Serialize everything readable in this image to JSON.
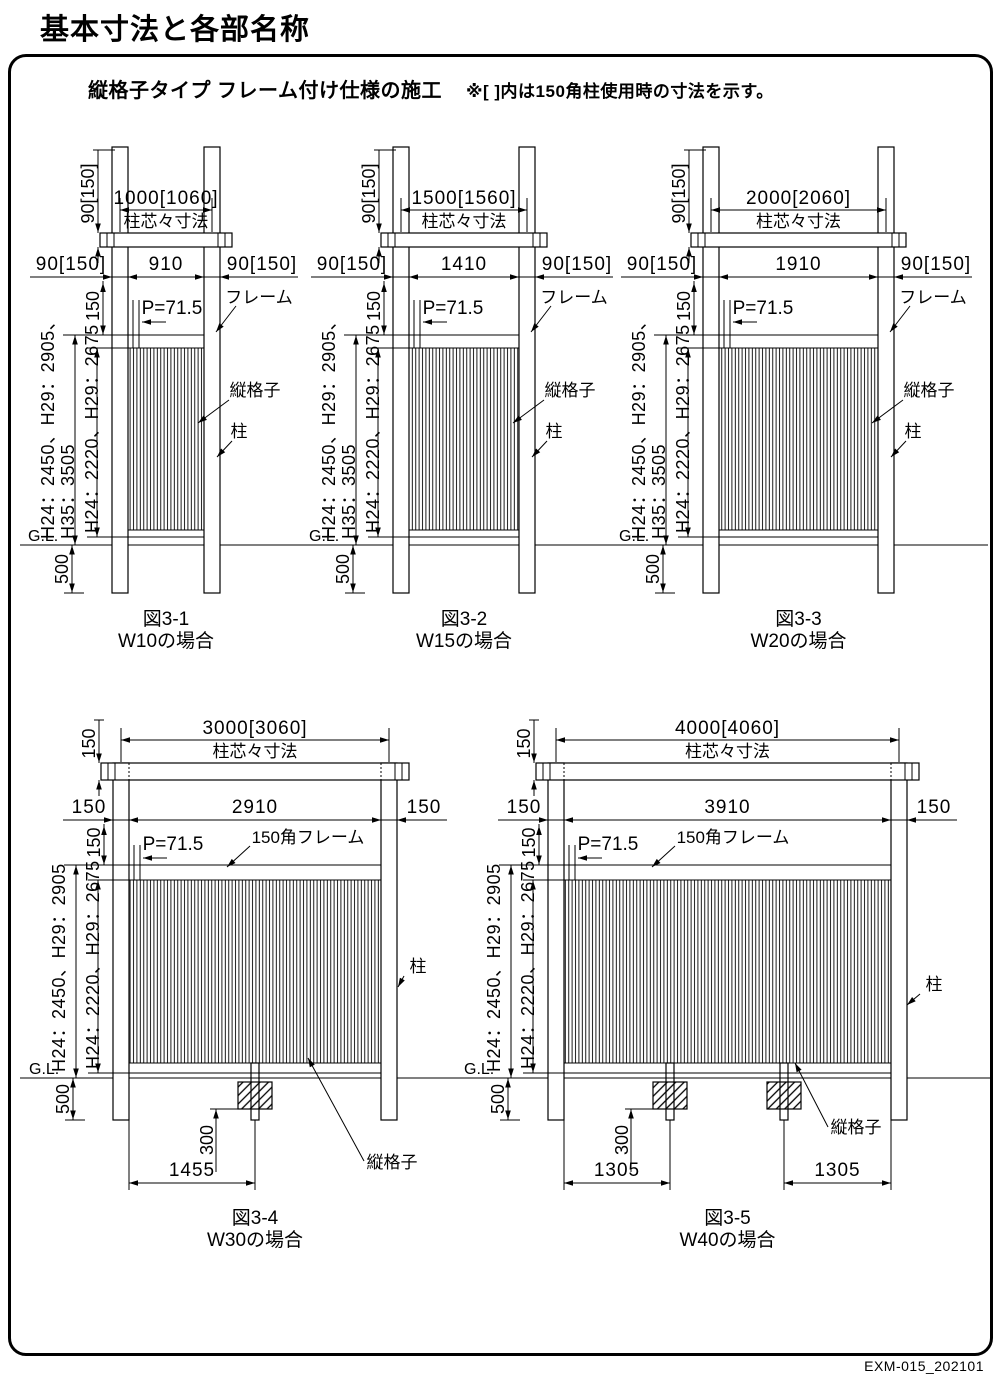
{
  "page": {
    "title": "基本寸法と各部名称",
    "footer_code": "EXM-015_202101"
  },
  "panel": {
    "heading": "縦格子タイプ フレーム付け仕様の施工",
    "note": "※[ ]内は150角柱使用時の寸法を示す。"
  },
  "figures": [
    {
      "key": "figure-3-1",
      "row": 1,
      "caption_no": "図3-1",
      "caption_case": "W10の場合",
      "geom": {
        "pl": 112,
        "pr": 204,
        "gl_l": 20,
        "gl_r": 310
      },
      "dims": {
        "rail_h": "90[150]",
        "span": "1000[1060]",
        "span_sub": "柱芯々寸法",
        "margin_l": "90[150]",
        "panel": "910",
        "margin_r": "90[150]",
        "frame_h": "150",
        "pitch": "P=71.5",
        "embed": "500"
      },
      "labels": {
        "frame": "フレーム",
        "lattice": "縦格子",
        "post": "柱",
        "gl": "G.L.",
        "h_outer": [
          "H24：2450、H29：2905、",
          "H35：3505"
        ],
        "h_inner": "H24：2220、H29：2675"
      }
    },
    {
      "key": "figure-3-2",
      "row": 1,
      "caption_no": "図3-2",
      "caption_case": "W15の場合",
      "geom": {
        "pl": 393,
        "pr": 519,
        "gl_l": 302,
        "gl_r": 616
      },
      "dims": {
        "rail_h": "90[150]",
        "span": "1500[1560]",
        "span_sub": "柱芯々寸法",
        "margin_l": "90[150]",
        "panel": "1410",
        "margin_r": "90[150]",
        "frame_h": "150",
        "pitch": "P=71.5",
        "embed": "500"
      },
      "labels": {
        "frame": "フレーム",
        "lattice": "縦格子",
        "post": "柱",
        "gl": "G.L.",
        "h_outer": [
          "H24：2450、H29：2905、",
          "H35：3505"
        ],
        "h_inner": "H24：2220、H29：2675"
      }
    },
    {
      "key": "figure-3-3",
      "row": 1,
      "caption_no": "図3-3",
      "caption_case": "W20の場合",
      "geom": {
        "pl": 703,
        "pr": 878,
        "gl_l": 614,
        "gl_r": 988
      },
      "dims": {
        "rail_h": "90[150]",
        "span": "2000[2060]",
        "span_sub": "柱芯々寸法",
        "margin_l": "90[150]",
        "panel": "1910",
        "margin_r": "90[150]",
        "frame_h": "150",
        "pitch": "P=71.5",
        "embed": "500"
      },
      "labels": {
        "frame": "フレーム",
        "lattice": "縦格子",
        "post": "柱",
        "gl": "G.L.",
        "h_outer": [
          "H24：2450、H29：2905、",
          "H35：3505"
        ],
        "h_inner": "H24：2220、H29：2675"
      }
    },
    {
      "key": "figure-3-4",
      "row": 2,
      "caption_no": "図3-4",
      "caption_case": "W30の場合",
      "geom": {
        "pl": 113,
        "pr": 381,
        "gl_l": 20,
        "gl_r": 452,
        "frame_lbl_x": 308,
        "mids": [
          {
            "x": 255,
            "depth_dim": true
          }
        ],
        "spacing": [
          {
            "a": 129,
            "b": 255,
            "label": "1455"
          }
        ],
        "lattice_lbl": {
          "x": 392,
          "y": 1168,
          "sx": 364,
          "sy": 1161,
          "tx": 308,
          "ty": 1058
        },
        "post_lbl": {
          "x": 418,
          "y": 972,
          "sx": 404,
          "sy": 976,
          "tx": 398,
          "ty": 987
        }
      },
      "dims": {
        "rail_h": "150",
        "span": "3000[3060]",
        "span_sub": "柱芯々寸法",
        "margin_l": "150",
        "panel": "2910",
        "margin_r": "150",
        "frame_h": "150",
        "pitch": "P=71.5",
        "embed": "500",
        "block_depth": "300"
      },
      "labels": {
        "frame": "150角フレーム",
        "lattice": "縦格子",
        "post": "柱",
        "gl": "G.L.",
        "h_outer": [
          "H24：2450、H29：2905"
        ],
        "h_inner": "H24：2220、H29：2675"
      }
    },
    {
      "key": "figure-3-5",
      "row": 2,
      "caption_no": "図3-5",
      "caption_case": "W40の場合",
      "geom": {
        "pl": 548,
        "pr": 891,
        "gl_l": 452,
        "gl_r": 990,
        "frame_lbl_x": 733,
        "mids": [
          {
            "x": 670,
            "depth_dim": true
          },
          {
            "x": 784,
            "depth_dim": false
          }
        ],
        "spacing": [
          {
            "a": 564,
            "b": 670,
            "label": "1305"
          },
          {
            "a": 784,
            "b": 891,
            "label": "1305"
          }
        ],
        "lattice_lbl": {
          "x": 856,
          "y": 1133,
          "sx": 828,
          "sy": 1127,
          "tx": 795,
          "ty": 1063
        },
        "post_lbl": {
          "x": 934,
          "y": 990,
          "sx": 920,
          "sy": 994,
          "tx": 907,
          "ty": 1005
        }
      },
      "dims": {
        "rail_h": "150",
        "span": "4000[4060]",
        "span_sub": "柱芯々寸法",
        "margin_l": "150",
        "panel": "3910",
        "margin_r": "150",
        "frame_h": "150",
        "pitch": "P=71.5",
        "embed": "500",
        "block_depth": "300"
      },
      "labels": {
        "frame": "150角フレーム",
        "lattice": "縦格子",
        "post": "柱",
        "gl": "G.L.",
        "h_outer": [
          "H24：2450、H29：2905"
        ],
        "h_inner": "H24：2220、H29：2675"
      }
    }
  ]
}
